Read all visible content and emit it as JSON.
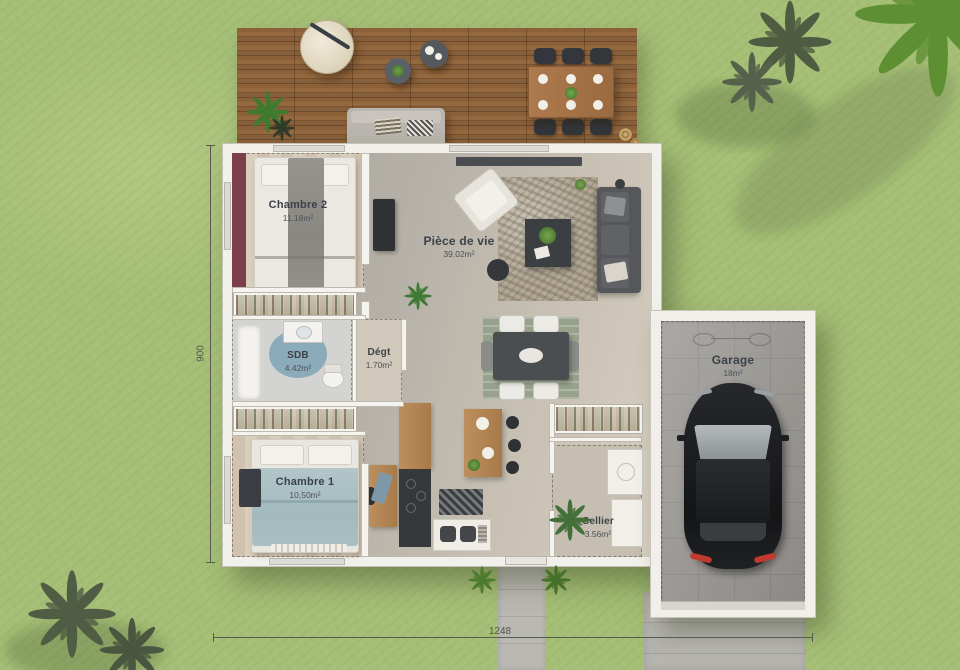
{
  "scene": {
    "width": 960,
    "height": 670,
    "description": "Top-view 3D floor plan of a single-storey house with terrace and garage on grass"
  },
  "rooms": {
    "chambre2": {
      "name": "Chambre 2",
      "area": "11.18m²"
    },
    "piece_de_vie": {
      "name": "Pièce de vie",
      "area": "39.02m²"
    },
    "sdb": {
      "name": "SDB",
      "area": "4.42m²"
    },
    "degt": {
      "name": "Dégt",
      "area": "1.70m²"
    },
    "chambre1": {
      "name": "Chambre 1",
      "area": "10,50m²"
    },
    "cellier": {
      "name": "Cellier",
      "area": "3.56m²"
    },
    "garage": {
      "name": "Garage",
      "area": "18m²"
    }
  },
  "dimensions": {
    "bottom_label": "1248",
    "left_label": "900"
  },
  "colors": {
    "grass": "#a6bf78",
    "deck_wood": "#875d36",
    "house_wall": "#f2f0ea",
    "accent_wall": "#7c3e4b",
    "bedroom1_blanket": "#a9bfc2",
    "bedroom2_blanket": "#908d87",
    "bathroom_rug": "#7ea8ba",
    "car_body": "#212326",
    "taillight_red": "#c23a2e",
    "label_text": "#3a4148"
  }
}
